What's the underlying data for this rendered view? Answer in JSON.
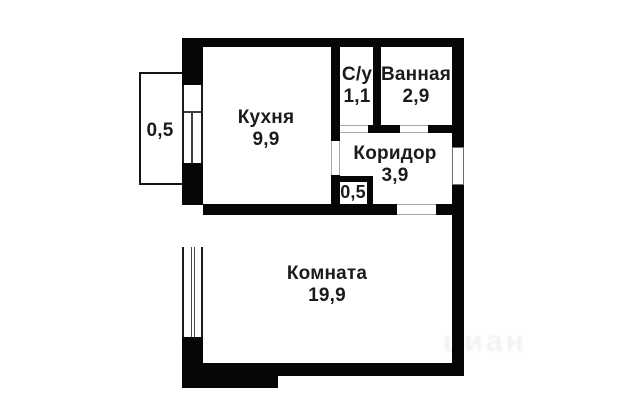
{
  "colors": {
    "background": "#ffffff",
    "wall": "#060606",
    "text": "#1b1b1b"
  },
  "rooms": [
    {
      "id": "kitchen",
      "name": "Кухня",
      "area": "9,9"
    },
    {
      "id": "wc",
      "name": "С/у",
      "area": "1,1"
    },
    {
      "id": "bathroom",
      "name": "Ванная",
      "area": "2,9"
    },
    {
      "id": "corridor",
      "name": "Коридор",
      "area": "3,9"
    },
    {
      "id": "living-room",
      "name": "Комната",
      "area": "19,9"
    },
    {
      "id": "balcony",
      "name": "",
      "area": "0,5"
    },
    {
      "id": "closet",
      "name": "",
      "area": "0,5"
    }
  ],
  "watermark": {
    "text": "циан"
  }
}
